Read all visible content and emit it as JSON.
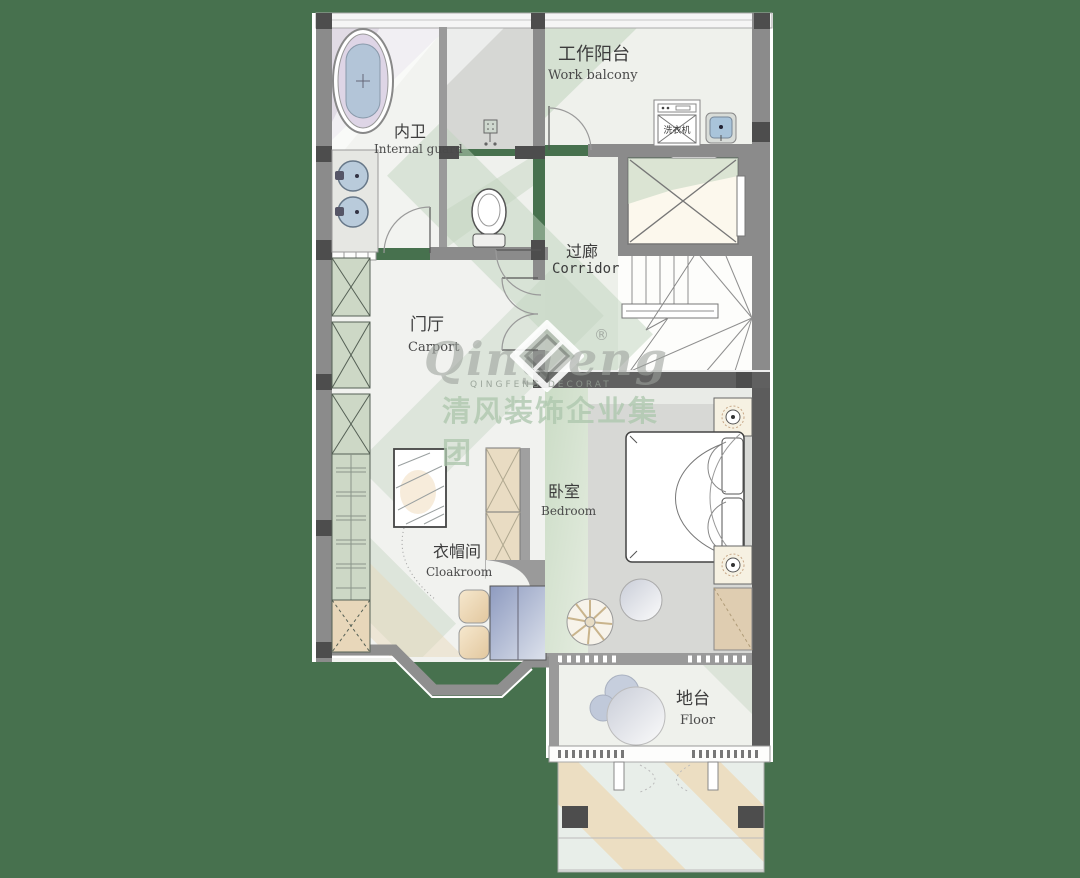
{
  "rooms": {
    "work_balcony": {
      "zh": "工作阳台",
      "en": "Work balcony"
    },
    "internal_bath": {
      "zh": "内卫",
      "en": "Internal guard"
    },
    "corridor": {
      "zh": "过廊",
      "en": "Corridor"
    },
    "entry_hall": {
      "zh": "门厅",
      "en": "Carport"
    },
    "bedroom": {
      "zh": "卧室",
      "en": "Bedroom"
    },
    "cloakroom": {
      "zh": "衣帽间",
      "en": "Cloakroom"
    },
    "platform": {
      "zh": "地台",
      "en": "Floor"
    }
  },
  "fixtures": {
    "washer_label": "洗衣机"
  },
  "watermark": {
    "brand_left": "Qing",
    "brand_right": "eng",
    "registered": "®",
    "tagline": "QINGFENG  DECORAT",
    "company_zh": "清风装饰企业集团"
  },
  "palette": {
    "canvas_bg": "#47714E",
    "wall_gray": "#8b8b8b",
    "wall_dark": "#4f4f4f",
    "floor_light": "#f1f2ef",
    "accent_green": "#c0d3bd",
    "accent_tan": "#e9d8b8",
    "accent_blue": "#aec3d8",
    "accent_lavender": "#cfc3da"
  }
}
